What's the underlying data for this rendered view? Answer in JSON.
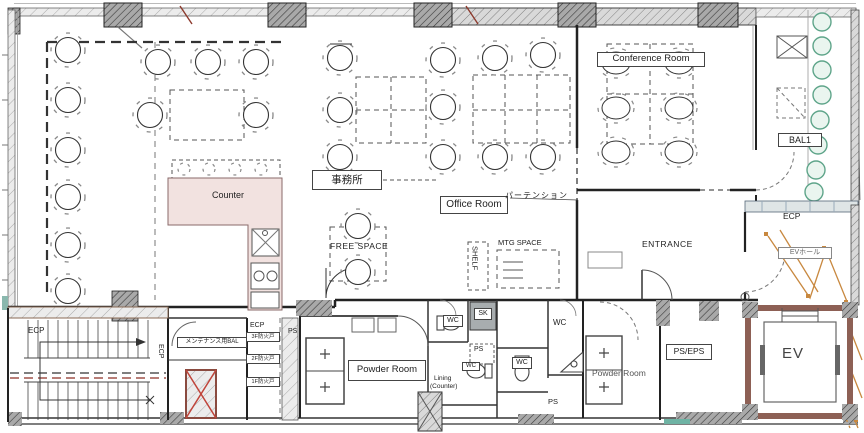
{
  "labels": {
    "conference_room": "Conference Room",
    "bal1": "BAL1",
    "ecp_balcony": "ECP",
    "ev_hall": "EVホール",
    "counter": "Counter",
    "office_jp": "事務所",
    "office_room": "Office Room",
    "partition": "パーテンション",
    "free_space": "FREE SPACE",
    "shelf": "SHELF",
    "mtg_space": "MTG SPACE",
    "entrance": "ENTRANCE",
    "ecp_stair": "ECP",
    "ecp_stair_side": "ECP",
    "maintenance_bal": "メンテナンス用BAL",
    "ecp_core": "ECP",
    "fire_door_3f": "3F防火戸",
    "fire_door_2f": "2F防火戸",
    "fire_door_1f": "1F防火戸",
    "ps_core": "PS",
    "ps_wc": "PS",
    "ps_bottom": "PS",
    "ps_eps": "PS/EPS",
    "sk": "SK",
    "wc_1": "WC",
    "wc_2": "WC",
    "wc_3": "WC",
    "wc_4": "WC",
    "powder_room_left": "Powder Room",
    "powder_room_right": "Powder Room",
    "lining_counter_1": "Lining",
    "lining_counter_2": "(Counter)",
    "ev": "EV"
  },
  "colors": {
    "counter_fill": "#f2e2e0",
    "plant_green": "#5fa58a",
    "ev_shaft_wall": "#8d6055",
    "revision_orange": "#c8883f",
    "accent_teal": "#6fb3a4"
  }
}
